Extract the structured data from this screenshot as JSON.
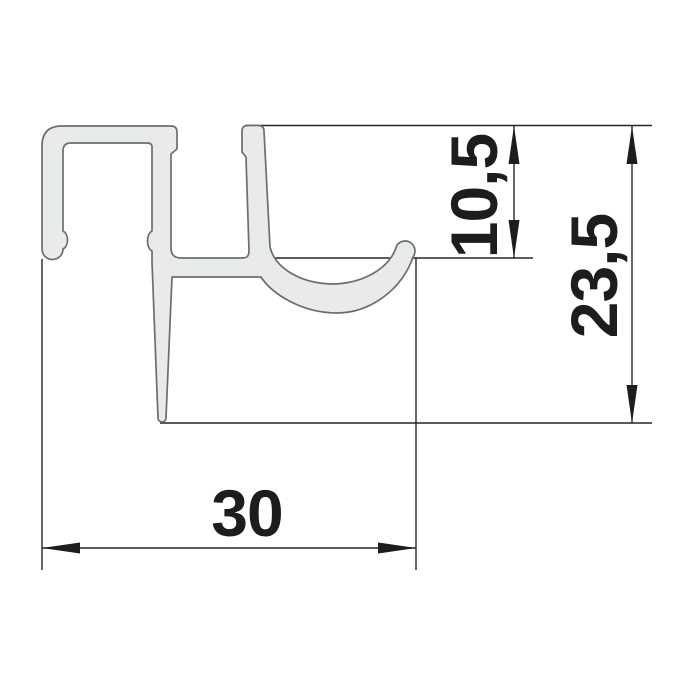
{
  "diagram": {
    "dimensions": {
      "hook_offset": {
        "value": "10,5"
      },
      "overall_height": {
        "value": "23,5"
      },
      "overall_width": {
        "value": "30"
      }
    },
    "colors": {
      "background": "#ffffff",
      "profile_fill": "#e9eaea",
      "profile_stroke": "#6a6e70",
      "line": "#262626",
      "ink": "#1d1d1b"
    }
  }
}
